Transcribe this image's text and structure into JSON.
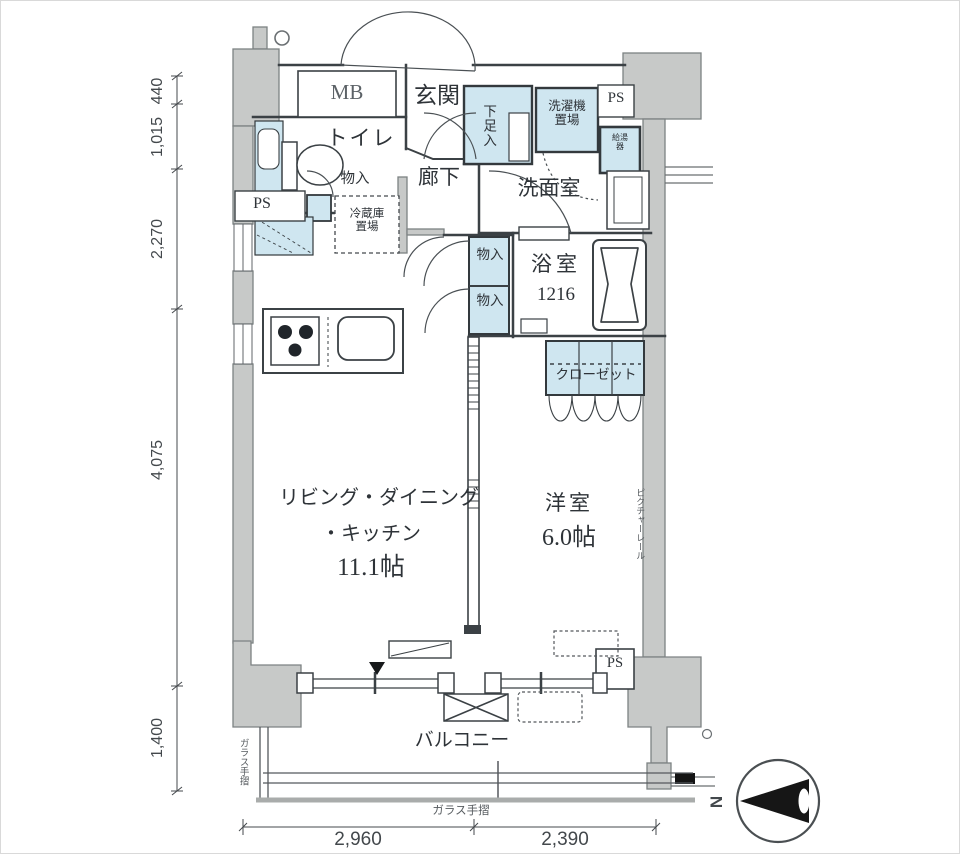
{
  "rooms": {
    "entrance": "玄関",
    "corridor": "廊下",
    "toilet": "トイレ",
    "washroom": "洗面室",
    "bathroom": "浴室",
    "bathroom_size": "1216",
    "ldk_line1": "リビング・ダイニング",
    "ldk_line2": "・キッチン",
    "ldk_size": "11.1帖",
    "western": "洋室",
    "western_size": "6.0帖",
    "closet": "クローゼット",
    "balcony": "バルコニー"
  },
  "features": {
    "meter_box": "MB",
    "shoe_cabinet": "下足入",
    "washer_space": "洗濯機置場",
    "fridge_space": "冷蔵庫置場",
    "storage_toilet": "物入",
    "storage_upper": "物入",
    "storage_lower": "物入",
    "ps_top": "PS",
    "ps_left": "PS",
    "ps_bottom": "PS",
    "water_heater": "給湯器",
    "picture_rail": "ピクチャーレール",
    "glass_rail_left": "ガラス手摺",
    "glass_rail_bottom": "ガラス手摺"
  },
  "dimensions": {
    "left": [
      "440",
      "1,015",
      "2,270",
      "4,075",
      "1,400"
    ],
    "bottom": [
      "2,960",
      "2,390"
    ]
  },
  "compass": {
    "north": "N"
  },
  "colors": {
    "wall": "#c7c9c8",
    "water": "#cfe6f0",
    "line": "#3b4145"
  }
}
